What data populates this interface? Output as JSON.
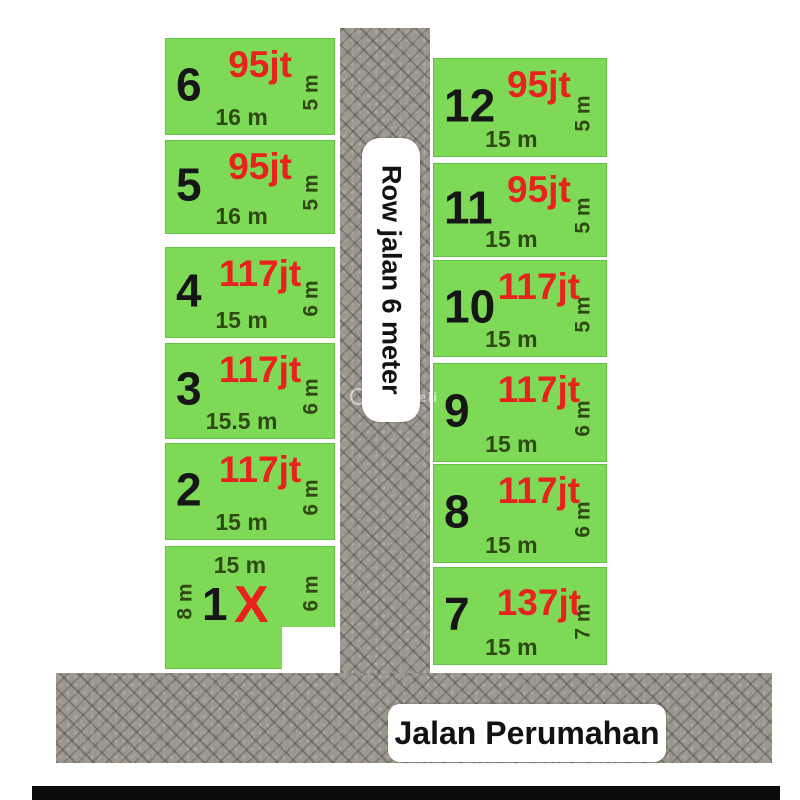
{
  "roads": {
    "vertical_label": "Row jalan 6 meter",
    "horizontal_label": "Jalan Perumahan"
  },
  "watermark": {
    "text": "JualBeli"
  },
  "colors": {
    "plot_green": "#7ed957",
    "price_red": "#e8231d",
    "dim_green": "#2e4a10",
    "road_gray": "#9b968e"
  },
  "plots_left": [
    {
      "number": "6",
      "price": "95jt",
      "width": "16 m",
      "depth": "5 m"
    },
    {
      "number": "5",
      "price": "95jt",
      "width": "16 m",
      "depth": "5 m"
    },
    {
      "number": "4",
      "price": "117jt",
      "width": "15 m",
      "depth": "6 m"
    },
    {
      "number": "3",
      "price": "117jt",
      "width": "15.5 m",
      "depth": "6 m"
    },
    {
      "number": "2",
      "price": "117jt",
      "width": "15 m",
      "depth": "6 m"
    },
    {
      "number": "1",
      "sold_marker": "X",
      "top_width": "15 m",
      "left_depth": "8 m",
      "right_depth": "6 m"
    }
  ],
  "plots_right": [
    {
      "number": "12",
      "price": "95jt",
      "width": "15 m",
      "depth": "5 m"
    },
    {
      "number": "11",
      "price": "95jt",
      "width": "15 m",
      "depth": "5 m"
    },
    {
      "number": "10",
      "price": "117jt",
      "width": "15 m",
      "depth": "5 m"
    },
    {
      "number": "9",
      "price": "117jt",
      "width": "15 m",
      "depth": "6 m"
    },
    {
      "number": "8",
      "price": "117jt",
      "width": "15 m",
      "depth": "6 m"
    },
    {
      "number": "7",
      "price": "137jt",
      "width": "15 m",
      "depth": "7 m"
    }
  ]
}
